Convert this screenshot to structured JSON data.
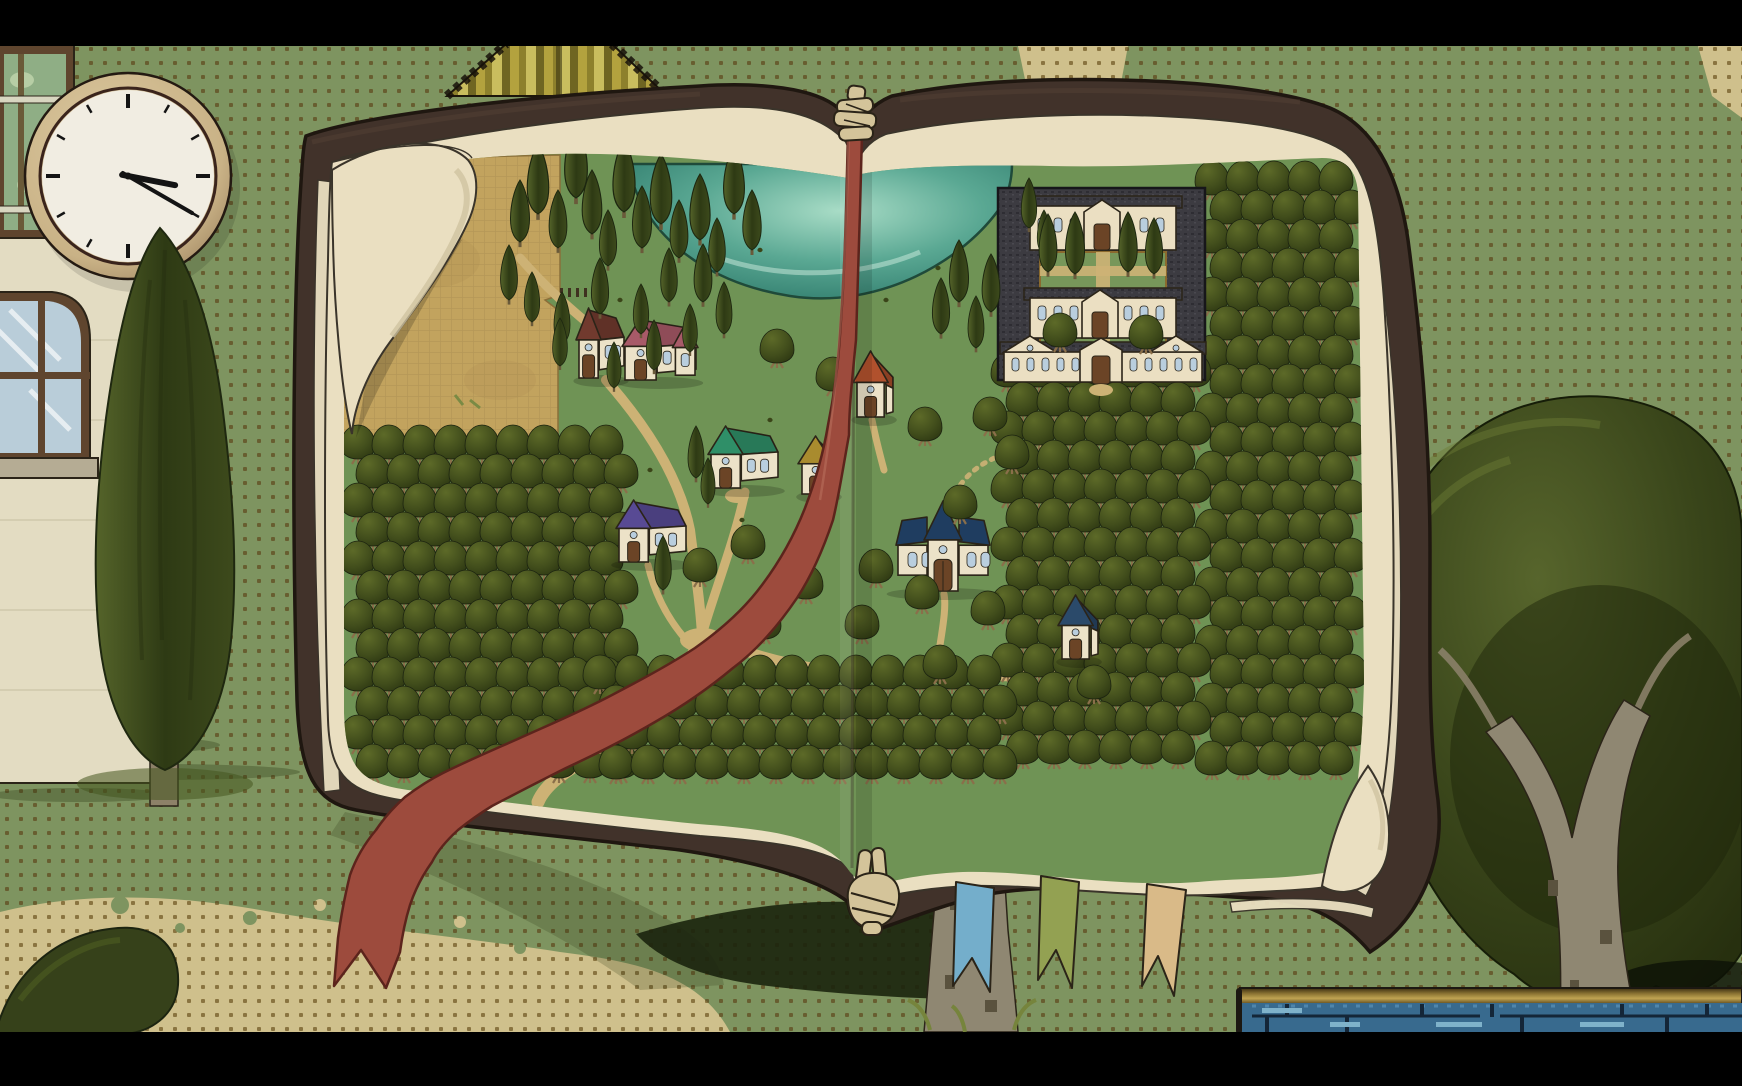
{
  "scene": {
    "description": "Letterboxed game screenshot: first-person hands holding an open leather-bound book showing a hand-painted village map; dotted green ground, wall clock, cypress tree, large round tree and blue pool around it",
    "view": "open-book-map",
    "letterbox": {
      "top_height": 46,
      "bottom_height": 54
    }
  },
  "clock": {
    "time": "3:20",
    "hour_angle_deg": 101,
    "minute_angle_deg": 120
  },
  "colors": {
    "letterbox": "#000000",
    "wallpaper": "#7e9460",
    "wallpaperDot": "#685e30",
    "sand": "#cfc08c",
    "sandDot": "#8a7440",
    "ink": "#2b2418",
    "cover": "#41322a",
    "coverEdge": "#1f1710",
    "coverLight": "#544034",
    "page": "#eadfc1",
    "pageLine": "#3a342a",
    "mapGreen": "#6f9355",
    "courtGreen": "#77975a",
    "field": "#c2a35e",
    "pathTan": "#cdb275",
    "lakeEdge": "#2e7a6b",
    "lakeMid": "#5aa893",
    "lakeLight": "#a8dcc6",
    "oliveDark": "#293310",
    "oliveMid": "#424e1c",
    "oliveLight": "#5d6a28",
    "oliveTrunk": "#8a6f4a",
    "cypressDark": "#2e3a14",
    "cypressLight": "#55642a",
    "wall": "#ece2c8",
    "windowBlue": "#b9cede",
    "door": "#6b4426",
    "ribbon": "#9d4b3d",
    "ribbonEdge": "#5c241c",
    "bmTeal": "#74aecb",
    "bmOlive": "#93a152",
    "bmTan": "#d9ba88",
    "hand": "#d4c49a",
    "clockFrame": "#c9b286",
    "clockFrameDark": "#9a7f5c",
    "clockFace": "#f1ede2",
    "clockHand": "#141414",
    "bigTreeLight": "#57652c",
    "bigTreeMid": "#39451a",
    "bigTreeDark": "#27300f",
    "sapling": "#8f8772",
    "saplingDark": "#5a523e",
    "poolWater": "#386a8e",
    "poolRail": "#8a7232",
    "poolLine": "#142638",
    "poolLight": "#7fb2ca",
    "buildingWall": "#e3dcc2",
    "glassGreen": "#8fae85",
    "glassBlue": "#b9cdd9",
    "frameWood": "#5f452e",
    "sill": "#b5ac94",
    "mansionRoof": "#3c3b41",
    "mansionWall": "#ebdfc2",
    "mansionTrim": "#8a6a2e",
    "shadowDark": "#1b230d",
    "shadowSoft": "#2c3813",
    "bush": "#36411a",
    "tentA": "#b3a23e",
    "tentB": "#8d802c",
    "tentC": "#c9bd5e",
    "tentD": "#6f6522",
    "grassTuft": "#76843c"
  },
  "book": {
    "ribbon": {
      "id": "ribbon-red",
      "color_ref": "ribbon"
    },
    "bookmarks": [
      {
        "id": "bookmark-teal",
        "color_ref": "bmTeal"
      },
      {
        "id": "bookmark-olive",
        "color_ref": "bmOlive"
      },
      {
        "id": "bookmark-tan",
        "color_ref": "bmTan"
      }
    ]
  },
  "map": {
    "houses": [
      {
        "id": "farmhouse-maroon",
        "x": 578,
        "y": 310,
        "w": 46,
        "h": 68,
        "roof": "#713a2e",
        "type": "house"
      },
      {
        "id": "farmhouse-pink",
        "x": 624,
        "y": 320,
        "w": 72,
        "h": 60,
        "roof": "#a85a68",
        "type": "long"
      },
      {
        "id": "house-green",
        "x": 710,
        "y": 428,
        "w": 68,
        "h": 60,
        "roof": "#2f8f68",
        "type": "house"
      },
      {
        "id": "house-gold",
        "x": 800,
        "y": 438,
        "w": 38,
        "h": 56,
        "roof": "#a98b2e",
        "type": "small"
      },
      {
        "id": "house-orange",
        "x": 855,
        "y": 353,
        "w": 38,
        "h": 64,
        "roof": "#b1512d",
        "type": "small"
      },
      {
        "id": "house-purple",
        "x": 618,
        "y": 502,
        "w": 68,
        "h": 60,
        "roof": "#584a94",
        "type": "house"
      },
      {
        "id": "house-blue",
        "x": 896,
        "y": 503,
        "w": 94,
        "h": 88,
        "roof": "#1f3d60",
        "type": "cross"
      },
      {
        "id": "house-navy",
        "x": 1060,
        "y": 597,
        "w": 38,
        "h": 62,
        "roof": "#2b4a6a",
        "type": "small"
      }
    ],
    "mansion": {
      "x": 998,
      "y": 188,
      "w": 207,
      "h": 194
    },
    "orchards": [
      {
        "x0": 358,
        "y0": 462,
        "x1": 630,
        "y1": 792,
        "dx": 31,
        "dy": 29,
        "st": 15
      },
      {
        "x0": 1212,
        "y0": 198,
        "x1": 1352,
        "y1": 795,
        "dx": 31,
        "dy": 29,
        "st": 15
      },
      {
        "x0": 1008,
        "y0": 390,
        "x1": 1208,
        "y1": 795,
        "dx": 31,
        "dy": 29,
        "st": 15
      },
      {
        "x0": 600,
        "y0": 692,
        "x1": 1005,
        "y1": 795,
        "dx": 32,
        "dy": 30,
        "st": 16
      }
    ],
    "olives": [
      [
        777,
        366
      ],
      [
        833,
        394
      ],
      [
        925,
        444
      ],
      [
        990,
        434
      ],
      [
        1012,
        472
      ],
      [
        960,
        522
      ],
      [
        922,
        612
      ],
      [
        862,
        642
      ],
      [
        806,
        602
      ],
      [
        748,
        562
      ],
      [
        700,
        585
      ],
      [
        764,
        642
      ],
      [
        988,
        628
      ],
      [
        940,
        682
      ],
      [
        1094,
        702
      ],
      [
        1060,
        350
      ],
      [
        1146,
        352
      ],
      [
        876,
        586
      ]
    ],
    "cypresses": [
      [
        520,
        242,
        62
      ],
      [
        538,
        214,
        70
      ],
      [
        558,
        248,
        58
      ],
      [
        576,
        198,
        74
      ],
      [
        592,
        234,
        64
      ],
      [
        608,
        266,
        56
      ],
      [
        624,
        212,
        72
      ],
      [
        642,
        248,
        62
      ],
      [
        661,
        224,
        70
      ],
      [
        679,
        258,
        58
      ],
      [
        700,
        240,
        66
      ],
      [
        717,
        272,
        54
      ],
      [
        734,
        214,
        68
      ],
      [
        752,
        250,
        60
      ],
      [
        509,
        300,
        55
      ],
      [
        532,
        322,
        50
      ],
      [
        562,
        344,
        52
      ],
      [
        600,
        314,
        56
      ],
      [
        641,
        334,
        50
      ],
      [
        669,
        302,
        54
      ],
      [
        560,
        366,
        48
      ],
      [
        614,
        388,
        46
      ],
      [
        654,
        370,
        50
      ],
      [
        690,
        352,
        48
      ],
      [
        703,
        302,
        58
      ],
      [
        724,
        334,
        52
      ],
      [
        696,
        478,
        52
      ],
      [
        708,
        504,
        46
      ],
      [
        663,
        590,
        54
      ],
      [
        941,
        334,
        56
      ],
      [
        959,
        302,
        62
      ],
      [
        976,
        348,
        52
      ],
      [
        991,
        312,
        58
      ],
      [
        1029,
        228,
        50
      ],
      [
        1044,
        254,
        44
      ],
      [
        1048,
        272,
        58
      ],
      [
        1075,
        274,
        62
      ],
      [
        1128,
        272,
        60
      ],
      [
        1154,
        274,
        56
      ]
    ],
    "specks": [
      [
        886,
        300
      ],
      [
        938,
        268
      ],
      [
        998,
        282
      ],
      [
        770,
        420
      ],
      [
        742,
        520
      ],
      [
        930,
        560
      ],
      [
        1008,
        560
      ],
      [
        820,
        700
      ],
      [
        650,
        470
      ],
      [
        540,
        480
      ],
      [
        760,
        250
      ],
      [
        620,
        300
      ],
      [
        1035,
        210
      ],
      [
        1068,
        236
      ]
    ]
  }
}
